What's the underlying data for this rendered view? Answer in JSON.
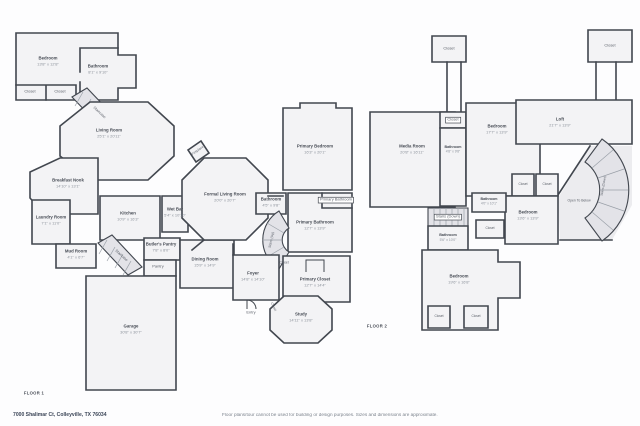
{
  "footer": {
    "address": "7000 Shalimar Ct, Colleyville, TX 76034",
    "disclaimer": "Floor plans/tour cannot be used for building or design purposes. Sizes and dimensions are approximate."
  },
  "colors": {
    "wall": "#42474f",
    "room_fill": "#f3f3f5",
    "stair_fill": "#e3e3e8",
    "room_name_text": "#474c55",
    "dims_text": "#8d939c",
    "address_text": "#3b4557",
    "disclaimer_text": "#7c838d"
  },
  "floor1": {
    "label": "FLOOR 1",
    "rooms": [
      {
        "name": "Bedroom",
        "dims": "13'8\" x 12'8\""
      },
      {
        "name": "Bathroom",
        "dims": "8'1\" x 9'10\""
      },
      {
        "name": "Closet"
      },
      {
        "name": "Closet"
      },
      {
        "name": "Staircase"
      },
      {
        "name": "Living Room",
        "dims": "25'1\" x 20'11\""
      },
      {
        "name": "Breakfast Nook",
        "dims": "14'10\" x 13'1\""
      },
      {
        "name": "Laundry Room",
        "dims": "7'1\" x 11'0\""
      },
      {
        "name": "Mud Room",
        "dims": "4'1\" x 6'7\""
      },
      {
        "name": "Staircase"
      },
      {
        "name": "Kitchen",
        "dims": "10'9\" x 16'3\""
      },
      {
        "name": "Wet Bar",
        "dims": "5'4\" x 10'10\""
      },
      {
        "name": "Butler's Pantry",
        "dims": "7'8\" x 8'0\""
      },
      {
        "name": "Pantry"
      },
      {
        "name": "Dining Room",
        "dims": "15'9\" x 14'9\""
      },
      {
        "name": "Garage",
        "dims": "30'8\" x 30'7\""
      },
      {
        "name": "Formal Living Room",
        "dims": "20'0\" x 20'7\""
      },
      {
        "name": "Fireplace"
      },
      {
        "name": "Primary Bedroom",
        "dims": "16'3\" x 20'1\""
      },
      {
        "name": "Bathroom",
        "dims": "4'5\" x 9'8\""
      },
      {
        "name": "Primary Bathroom"
      },
      {
        "name": "Primary Bathroom",
        "dims": "12'7\" x 13'9\""
      },
      {
        "name": "Stairs (Up)"
      },
      {
        "name": "Closet"
      },
      {
        "name": "Foyer",
        "dims": "14'8\" x 14'10\""
      },
      {
        "name": "Primary Closet",
        "dims": "12'7\" x 14'4\""
      },
      {
        "name": "Closet"
      },
      {
        "name": "Study",
        "dims": "14'11\" x 13'8\""
      },
      {
        "name": "Entry"
      }
    ]
  },
  "floor2": {
    "label": "FLOOR 2",
    "rooms": [
      {
        "name": "Media Room",
        "dims": "20'8\" x 16'11\""
      },
      {
        "name": "Closet"
      },
      {
        "name": "Closet"
      },
      {
        "name": "Closet"
      },
      {
        "name": "Bathroom",
        "dims": "4'8\" x 9'8\""
      },
      {
        "name": "Bedroom",
        "dims": "17'7\" x 13'9\""
      },
      {
        "name": "Loft",
        "dims": "21'7\" x 13'9\""
      },
      {
        "name": "Stairs (Down)"
      },
      {
        "name": "Open To Below"
      },
      {
        "name": "Closet"
      },
      {
        "name": "Closet"
      },
      {
        "name": "Bedroom",
        "dims": "13'6\" x 13'9\""
      },
      {
        "name": "Stairs (Down)"
      },
      {
        "name": "Bathroom",
        "dims": "5'6\" x 10'0\""
      },
      {
        "name": "Bathroom",
        "dims": "4'0\" x 10'1\""
      },
      {
        "name": "Closet"
      },
      {
        "name": "Bedroom",
        "dims": "19'6\" x 16'8\""
      },
      {
        "name": "Closet"
      },
      {
        "name": "Closet"
      }
    ]
  }
}
